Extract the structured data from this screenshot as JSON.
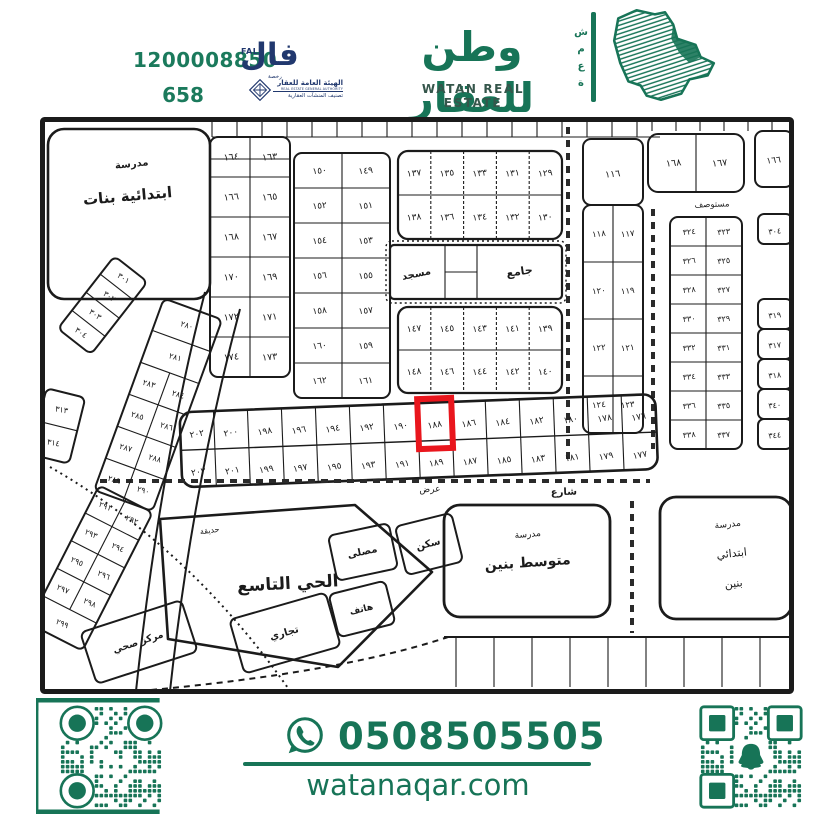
{
  "header": {
    "fal": {
      "phone": "1200008850",
      "license": "658",
      "logo_ar": "فال",
      "logo_en": "FAL",
      "logo_sub": "رخصة",
      "authority_line1": "الهيئة العامة للعقار",
      "authority_line2": "REAL ESTATE GENERAL AUTHORITY",
      "authority_line3": "تصنيف المنشآت العقارية"
    },
    "brand": {
      "name_ar": "وطن للعقار",
      "name_en": "WATAN REAL ESTATE",
      "side_word_letters": [
        "ش",
        "م",
        "ع",
        "ة"
      ]
    }
  },
  "footer": {
    "whatsapp_number": "0508505505",
    "website": "watanaqar.com"
  },
  "colors": {
    "brand_green": "#177457",
    "navy": "#21386e",
    "highlight_red": "#e9161d",
    "map_ink": "#1b1b1b"
  },
  "map": {
    "highlight_plot": "١٨٨",
    "strip": {
      "top": [
        "١٧٦",
        "١٧٨",
        "١٨٠",
        "١٨٢",
        "١٨٤",
        "١٨٦",
        "١٨٨",
        "١٩٠",
        "١٩٢",
        "١٩٤",
        "١٩٦",
        "١٩٨",
        "٢٠٠",
        "٢٠٢"
      ],
      "bottom": [
        "١٧٧",
        "١٧٩",
        "١٨١",
        "١٨٣",
        "١٨٥",
        "١٨٧",
        "١٨٩",
        "١٩١",
        "١٩٣",
        "١٩٥",
        "١٩٧",
        "١٩٩",
        "٢٠١",
        "٢٠٣"
      ]
    },
    "col_163": [
      [
        "١٦٤",
        "١٦٣"
      ],
      [
        "١٦٦",
        "١٦٥"
      ],
      [
        "١٦٨",
        "١٦٧"
      ],
      [
        "١٧٠",
        "١٦٩"
      ],
      [
        "١٧٢",
        "١٧١"
      ],
      [
        "١٧٤",
        "١٧٣"
      ]
    ],
    "col_149": [
      [
        "١٥٠",
        "١٤٩"
      ],
      [
        "١٥٢",
        "١٥١"
      ],
      [
        "١٥٤",
        "١٥٣"
      ],
      [
        "١٥٦",
        "١٥٥"
      ],
      [
        "١٥٨",
        "١٥٧"
      ],
      [
        "١٦٠",
        "١٥٩"
      ],
      [
        "١٦٢",
        "١٦١"
      ]
    ],
    "grid_129": [
      [
        "١٣٧",
        "١٣٥",
        "١٣٣",
        "١٣١",
        "١٢٩"
      ],
      [
        "١٣٨",
        "١٣٦",
        "١٣٤",
        "١٣٢",
        "١٣٠"
      ]
    ],
    "grid_139": [
      [
        "١٤٧",
        "١٤٥",
        "١٤٣",
        "١٤١",
        "١٣٩"
      ],
      [
        "١٤٨",
        "١٤٦",
        "١٤٤",
        "١٤٢",
        "١٤٠"
      ]
    ],
    "col_116_single": "١١٦",
    "col_116": [
      [
        "١١٨",
        "١١٧"
      ],
      [
        "١٢٠",
        "١١٩"
      ],
      [
        "١٢٢",
        "١٢١"
      ],
      [
        "١٢٤",
        "١٢٣"
      ]
    ],
    "block_167": [
      [
        "١٦٨",
        "١٦٧"
      ]
    ],
    "block_166": "١٦٦",
    "col_323": [
      [
        "٣٢٤",
        "٣٢٣"
      ],
      [
        "٣٢٦",
        "٣٢٥"
      ],
      [
        "٣٢٨",
        "٣٢٧"
      ],
      [
        "٣٣٠",
        "٣٢٩"
      ],
      [
        "٣٣٢",
        "٣٣١"
      ],
      [
        "٣٣٤",
        "٣٣٣"
      ],
      [
        "٣٣٦",
        "٣٣٥"
      ],
      [
        "٣٣٨",
        "٣٣٧"
      ]
    ],
    "right_edge_top": "٣٠٤",
    "right_edge": [
      "٣١٩",
      "٣١٧",
      "٣١٨",
      "٣٤٠",
      "٣٤٤"
    ],
    "diag_280": [
      "٢٨٠",
      "٢٨١",
      [
        "٢٨٣",
        "٢٨٤"
      ],
      [
        "٢٨٥",
        "٢٨٦"
      ],
      [
        "٢٨٧",
        "٢٨٨"
      ],
      [
        "٢٨٩",
        "٢٩٠"
      ]
    ],
    "diag_291": [
      [
        "٢٩١",
        "٢٩٢"
      ],
      [
        "٢٩٣",
        "٢٩٤"
      ],
      [
        "٢٩٥",
        "٢٩٦"
      ],
      [
        "٢٩٧",
        "٢٩٨"
      ],
      "٢٩٩"
    ],
    "diag_301": [
      "٣٠١",
      "٣٠٢",
      "٣٠٣",
      "٣٠٤"
    ],
    "cells_313": [
      "٣١٣",
      "٣١٤"
    ],
    "labels": {
      "girls_school": [
        "مدرسة",
        "ابتدائية بنات"
      ],
      "middle_school": [
        "مدرسة",
        "متوسط بنين"
      ],
      "primary_school": [
        "مدرسة",
        "ابتدائي",
        "بنين"
      ],
      "mosque_small": "مسجد",
      "mosque_large": "جامع",
      "district": "الحي التاسع",
      "park": "حديقة",
      "musalla": "مصلى",
      "sakan": "سكن",
      "tijari": "تجاري",
      "hatef": "هاتف",
      "health_center": "مركز صحي",
      "clinic": "مستوصف",
      "street": "شارع",
      "street2": "عرض"
    }
  }
}
